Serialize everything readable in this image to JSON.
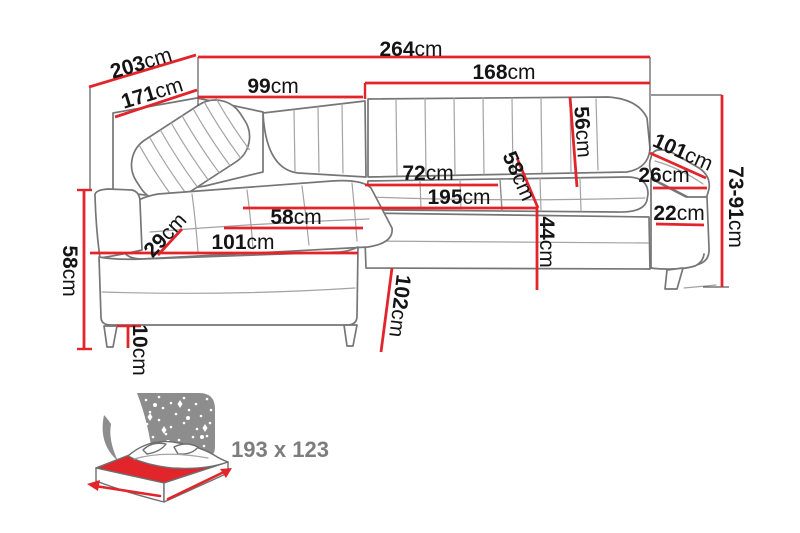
{
  "colors": {
    "dimension_red": "#e2252b",
    "outline_gray": "#767676",
    "label_black": "#141414",
    "icon_gray": "#8d8d8d",
    "icon_label_gray": "#7d7d7d",
    "background": "#ffffff"
  },
  "diagram": {
    "unit": "cm",
    "dimensions": [
      {
        "name": "overall-width",
        "value": "264",
        "unit": "cm",
        "line": [
          198,
          57,
          650,
          57
        ],
        "label": [
          411,
          49
        ],
        "rotate": 0
      },
      {
        "name": "overall-depth",
        "value": "203",
        "unit": "cm",
        "line": [
          89,
          87,
          196,
          55
        ],
        "label": [
          141,
          63
        ],
        "rotate": -17
      },
      {
        "name": "inner-depth",
        "value": "171",
        "unit": "cm",
        "line": [
          115,
          117,
          197,
          90
        ],
        "label": [
          152,
          93
        ],
        "rotate": -17
      },
      {
        "name": "corner-back-width",
        "value": "99",
        "unit": "cm",
        "line": [
          198,
          97,
          363,
          97
        ],
        "label": [
          273,
          86
        ],
        "rotate": 0
      },
      {
        "name": "right-back-width",
        "value": "168",
        "unit": "cm",
        "line": [
          365,
          83,
          650,
          83
        ],
        "label": [
          504,
          72
        ],
        "rotate": 0
      },
      {
        "name": "backrest-height",
        "value": "56",
        "unit": "cm",
        "line": [
          570,
          97,
          577,
          187
        ],
        "label": [
          583,
          132
        ],
        "rotate": 86
      },
      {
        "name": "armrest-length",
        "value": "101",
        "unit": "cm",
        "line": [
          650,
          153,
          706,
          178
        ],
        "label": [
          683,
          152
        ],
        "rotate": 24
      },
      {
        "name": "armrest-top-width",
        "value": "26",
        "unit": "cm",
        "line": [
          653,
          188,
          707,
          188
        ],
        "label": [
          664,
          175
        ],
        "rotate": 0
      },
      {
        "name": "overall-height",
        "value": "73-91",
        "unit": "cm",
        "line": [
          722,
          95,
          722,
          287
        ],
        "label": [
          736,
          207
        ],
        "rotate": 90
      },
      {
        "name": "seat-depth-right",
        "value": "72",
        "unit": "cm",
        "line": [
          365,
          185,
          498,
          185
        ],
        "label": [
          428,
          173
        ],
        "rotate": 0
      },
      {
        "name": "seat-depth-diagonal",
        "value": "58",
        "unit": "cm",
        "line": [
          517,
          158,
          538,
          208
        ],
        "label": [
          519,
          176
        ],
        "rotate": 66
      },
      {
        "name": "front-length",
        "value": "195",
        "unit": "cm",
        "line": [
          243,
          208,
          537,
          208
        ],
        "label": [
          459,
          197
        ],
        "rotate": 0
      },
      {
        "name": "seat-front-height",
        "value": "44",
        "unit": "cm",
        "line": [
          537,
          208,
          537,
          290
        ],
        "label": [
          547,
          242
        ],
        "rotate": 90
      },
      {
        "name": "chaise-seat-width",
        "value": "58",
        "unit": "cm",
        "line": [
          224,
          228,
          363,
          228
        ],
        "label": [
          296,
          217
        ],
        "rotate": 0
      },
      {
        "name": "chaise-corner-width",
        "value": "29",
        "unit": "cm",
        "line": [
          158,
          255,
          182,
          229
        ],
        "label": [
          165,
          235
        ],
        "rotate": -47
      },
      {
        "name": "chaise-length",
        "value": "101",
        "unit": "cm",
        "line": [
          90,
          253,
          358,
          253
        ],
        "label": [
          243,
          242
        ],
        "rotate": 0
      },
      {
        "name": "chaise-side-height",
        "value": "58",
        "unit": "cm",
        "line": [
          84,
          190,
          84,
          349
        ],
        "label": [
          70,
          271
        ],
        "rotate": 90
      },
      {
        "name": "fold-out-depth",
        "value": "102",
        "unit": "cm",
        "line": [
          392,
          268,
          381,
          352
        ],
        "label": [
          400,
          306
        ],
        "rotate": 97
      },
      {
        "name": "leg-height",
        "value": "10",
        "unit": "cm",
        "line": [
          128,
          326,
          128,
          348
        ],
        "label": [
          140,
          350
        ],
        "rotate": 90
      },
      {
        "name": "armrest-side-height",
        "value": "22",
        "unit": "cm",
        "line": [
          656,
          224,
          704,
          225
        ],
        "label": [
          679,
          213
        ],
        "rotate": 0
      }
    ]
  },
  "bed_icon": {
    "size_label": "193 x 123"
  }
}
